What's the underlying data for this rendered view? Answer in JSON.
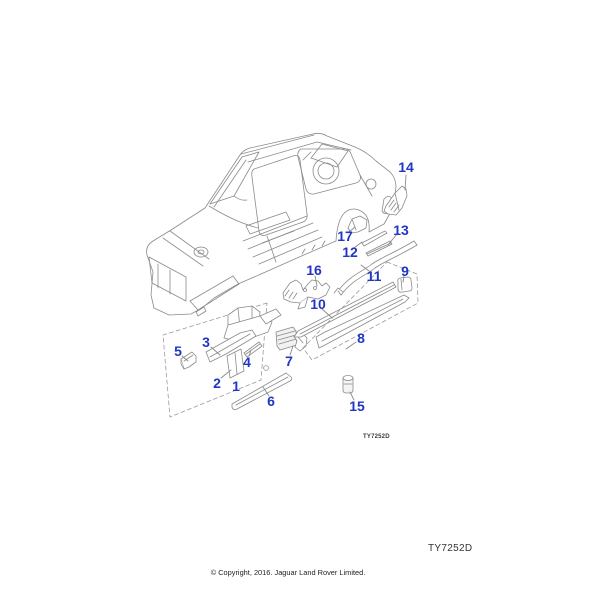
{
  "page": {
    "background": "#ffffff"
  },
  "diagram": {
    "inline_code": "TY7252D",
    "footer_code": "TY7252D",
    "copyright": "© Copyright, 2016. Jaguar Land Rover Limited.",
    "callout_color": "#2136c4",
    "line_color": "#8a8a8a",
    "callouts": [
      {
        "label": "1",
        "x": 236,
        "y": 386
      },
      {
        "label": "2",
        "x": 217,
        "y": 383,
        "leader": [
          221,
          378,
          231,
          370
        ]
      },
      {
        "label": "3",
        "x": 206,
        "y": 342,
        "leader": [
          211,
          347,
          220,
          355
        ]
      },
      {
        "label": "4",
        "x": 247,
        "y": 362,
        "leader": [
          249,
          356,
          251,
          350
        ]
      },
      {
        "label": "5",
        "x": 178,
        "y": 351,
        "leader": [
          182,
          356,
          188,
          361
        ]
      },
      {
        "label": "6",
        "x": 271,
        "y": 401,
        "leader": [
          269,
          396,
          263,
          387
        ]
      },
      {
        "label": "7",
        "x": 289,
        "y": 361,
        "leader": [
          290,
          355,
          293,
          346
        ]
      },
      {
        "label": "8",
        "x": 361,
        "y": 338,
        "leader": [
          356,
          342,
          346,
          349
        ]
      },
      {
        "label": "9",
        "x": 405,
        "y": 271,
        "leader": [
          404,
          276,
          403,
          282
        ]
      },
      {
        "label": "10",
        "x": 318,
        "y": 304,
        "leader": [
          322,
          309,
          331,
          317
        ]
      },
      {
        "label": "11",
        "x": 374,
        "y": 276,
        "leader": [
          369,
          271,
          361,
          265
        ]
      },
      {
        "label": "12",
        "x": 350,
        "y": 252,
        "leader": [
          354,
          248,
          362,
          242
        ]
      },
      {
        "label": "13",
        "x": 401,
        "y": 230,
        "leader": [
          397,
          234,
          388,
          245
        ]
      },
      {
        "label": "14",
        "x": 406,
        "y": 167,
        "leader": [
          406,
          175,
          405,
          190
        ]
      },
      {
        "label": "15",
        "x": 357,
        "y": 406,
        "leader": [
          354,
          400,
          350,
          392
        ]
      },
      {
        "label": "16",
        "x": 314,
        "y": 270,
        "leader": [
          315,
          276,
          317,
          286
        ]
      },
      {
        "label": "17",
        "x": 345,
        "y": 236,
        "leader": [
          349,
          232,
          355,
          227
        ]
      }
    ]
  }
}
